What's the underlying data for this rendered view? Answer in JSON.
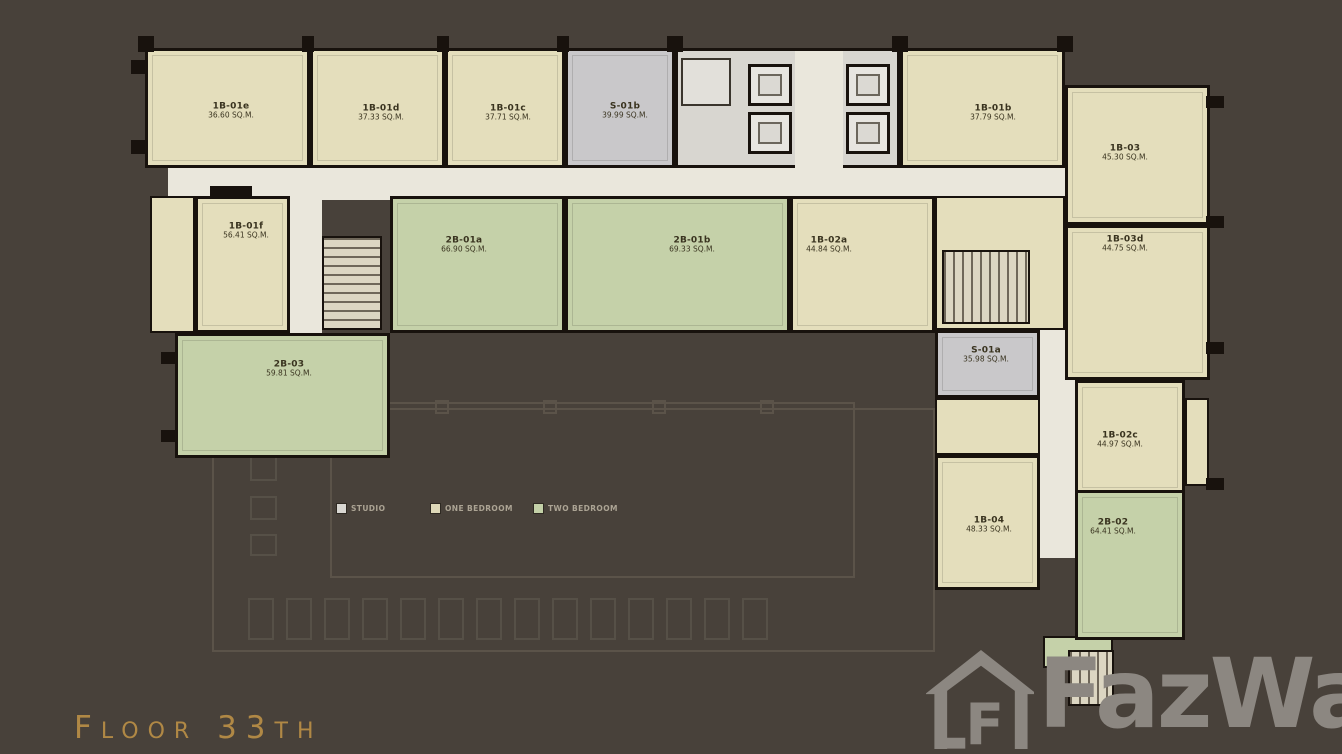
{
  "canvas": {
    "background": "#48413A",
    "width": 1342,
    "height": 754
  },
  "floor_title": {
    "text": "Floor 33th",
    "color": "#B08845"
  },
  "watermark": {
    "brand": "FazWaz",
    "icon": "fazwaz-house-icon",
    "color": "#8C8781"
  },
  "legend": {
    "items": [
      {
        "label": "STUDIO",
        "color": "#D9D7D2",
        "type": "studio"
      },
      {
        "label": "ONE BEDROOM",
        "color": "#DED8B8",
        "type": "one_bedroom"
      },
      {
        "label": "TWO BEDROOM",
        "color": "#C3D0A7",
        "type": "two_bedroom"
      }
    ]
  },
  "floor_plan": {
    "colors": {
      "one_bedroom": "#E4DEBC",
      "two_bedroom": "#C5D1A9",
      "studio": "#C9C8CA",
      "corridor": "#EAE7DC",
      "wall": "#18120D"
    },
    "units": [
      {
        "id": "1B-01e",
        "area": "36.60 SQ.M.",
        "type": "one_bedroom",
        "rect": [
          145,
          48,
          165,
          120
        ],
        "label_at": [
          228,
          108
        ]
      },
      {
        "id": "1B-01d",
        "area": "37.33 SQ.M.",
        "type": "one_bedroom",
        "rect": [
          310,
          48,
          135,
          120
        ],
        "label_at": [
          378,
          110
        ]
      },
      {
        "id": "1B-01c",
        "area": "37.71 SQ.M.",
        "type": "one_bedroom",
        "rect": [
          445,
          48,
          120,
          120
        ],
        "label_at": [
          505,
          110
        ]
      },
      {
        "id": "S-01b",
        "area": "39.99 SQ.M.",
        "type": "studio",
        "rect": [
          565,
          48,
          110,
          120
        ],
        "label_at": [
          622,
          108
        ]
      },
      {
        "id": "1B-01b",
        "area": "37.79 SQ.M.",
        "type": "one_bedroom",
        "rect": [
          900,
          48,
          165,
          120
        ],
        "label_at": [
          990,
          110
        ]
      },
      {
        "id": "1B-03",
        "area": "45.30 SQ.M.",
        "type": "one_bedroom",
        "rect": [
          1065,
          85,
          145,
          140
        ],
        "label_at": [
          1122,
          150
        ]
      },
      {
        "id": "1B-01f",
        "area": "56.41 SQ.M.",
        "type": "one_bedroom",
        "rect": [
          195,
          196,
          95,
          137
        ],
        "label_at": [
          243,
          228
        ]
      },
      {
        "id": "2B-01a",
        "area": "66.90 SQ.M.",
        "type": "two_bedroom",
        "rect": [
          390,
          196,
          175,
          137
        ],
        "label_at": [
          461,
          242
        ]
      },
      {
        "id": "2B-01b",
        "area": "69.33 SQ.M.",
        "type": "two_bedroom",
        "rect": [
          565,
          196,
          225,
          137
        ],
        "label_at": [
          689,
          242
        ]
      },
      {
        "id": "1B-02a",
        "area": "44.84 SQ.M.",
        "type": "one_bedroom",
        "rect": [
          790,
          196,
          145,
          137
        ],
        "label_at": [
          826,
          242
        ]
      },
      {
        "id": "1B-03d",
        "area": "44.75 SQ.M.",
        "type": "one_bedroom",
        "rect": [
          1065,
          225,
          145,
          155
        ],
        "label_at": [
          1122,
          241
        ]
      },
      {
        "id": "2B-03",
        "area": "59.81 SQ.M.",
        "type": "two_bedroom",
        "rect": [
          175,
          333,
          215,
          125
        ],
        "label_at": [
          286,
          366
        ]
      },
      {
        "id": "S-01a",
        "area": "35.98 SQ.M.",
        "type": "studio",
        "rect": [
          935,
          330,
          105,
          68
        ],
        "label_at": [
          983,
          352
        ]
      },
      {
        "id": "1B-02c",
        "area": "44.97 SQ.M.",
        "type": "one_bedroom",
        "rect": [
          1075,
          380,
          110,
          115
        ],
        "label_at": [
          1117,
          437
        ]
      },
      {
        "id": "1B-04",
        "area": "48.33 SQ.M.",
        "type": "one_bedroom",
        "rect": [
          935,
          455,
          105,
          135
        ],
        "label_at": [
          986,
          522
        ]
      },
      {
        "id": "2B-02",
        "area": "64.41 SQ.M.",
        "type": "two_bedroom",
        "rect": [
          1075,
          490,
          110,
          150
        ],
        "label_at": [
          1110,
          524
        ]
      }
    ],
    "facilities": {
      "elevators": 4,
      "staircases": 2
    }
  }
}
